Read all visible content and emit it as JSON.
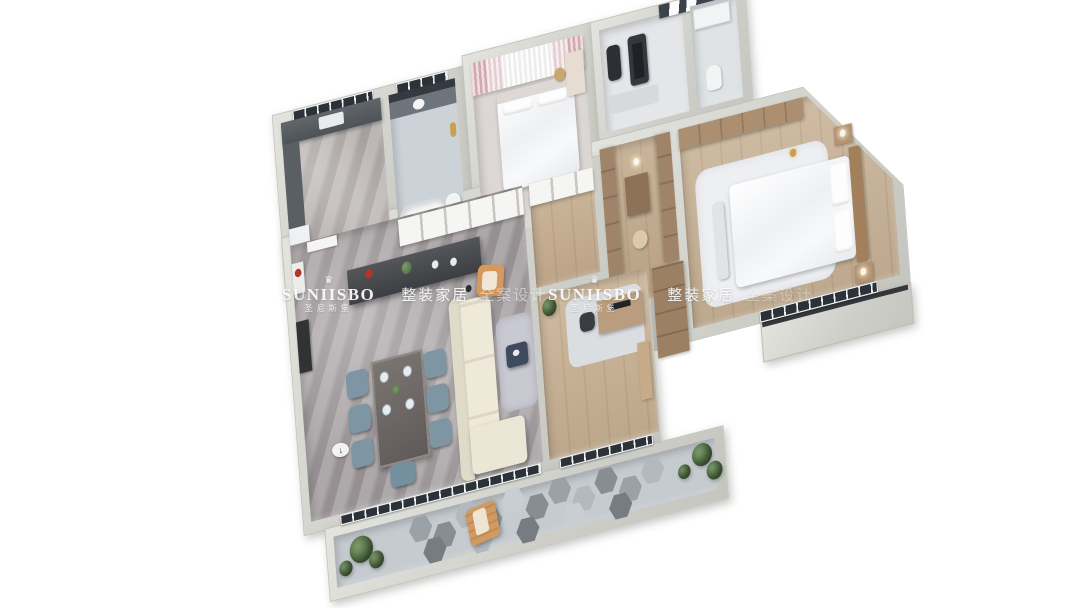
{
  "scene": {
    "type": "3d-isometric-floorplan-render",
    "background": "#ffffff",
    "marker_glyph": "↓"
  },
  "watermark": {
    "crown_glyph": "♛",
    "brand": "SUNIISBO",
    "brand_cn": "圣尼斯堡",
    "tagline_primary": "整装家居",
    "tagline_secondary": "全案设计",
    "instances": 2
  },
  "palette": {
    "wall": "#d0d0ca",
    "wall_light": "#e6e6e0",
    "window_glass": "#2c3238",
    "bed_white": "#f4f5f7",
    "sofa_cream": "#eae4d4",
    "dining_chair_blue": "#7e96a4",
    "accent_orange": "#d5995d",
    "accent_red": "#b43527",
    "accent_gold": "#c9a04e",
    "plant_green": "#55734d",
    "island_dark": "#43464b",
    "coffee_table_blue": "#3f4a5e",
    "ledge_tan": "#b3a28a"
  },
  "rooms": {
    "kitchen": {
      "label": "kitchen",
      "floor": "#b2acaa"
    },
    "bathroom": {
      "label": "bathroom",
      "floor": "#ccd3d8"
    },
    "bedroom_second": {
      "label": "secondary-bedroom",
      "floor": "#dcd7d4"
    },
    "gym": {
      "label": "gym-room",
      "floor": "#e4e6e9"
    },
    "gym_bath": {
      "label": "washroom",
      "floor": "#dfe3e6"
    },
    "dressing": {
      "label": "walk-in-closet",
      "floor": "#c3ab8d"
    },
    "master_bedroom": {
      "label": "master-bedroom",
      "floor": "#c9b397"
    },
    "hallway": {
      "label": "hallway",
      "floor": "#c7ae90"
    },
    "study": {
      "label": "study-room",
      "floor": "#c9b193"
    },
    "living_dining": {
      "label": "living-dining-room",
      "floor": "#a19b9d"
    },
    "balcony": {
      "label": "balcony",
      "floor": "#c6cbd0"
    },
    "ledge": {
      "label": "side-terrace",
      "floor": "#b3a28a"
    }
  }
}
